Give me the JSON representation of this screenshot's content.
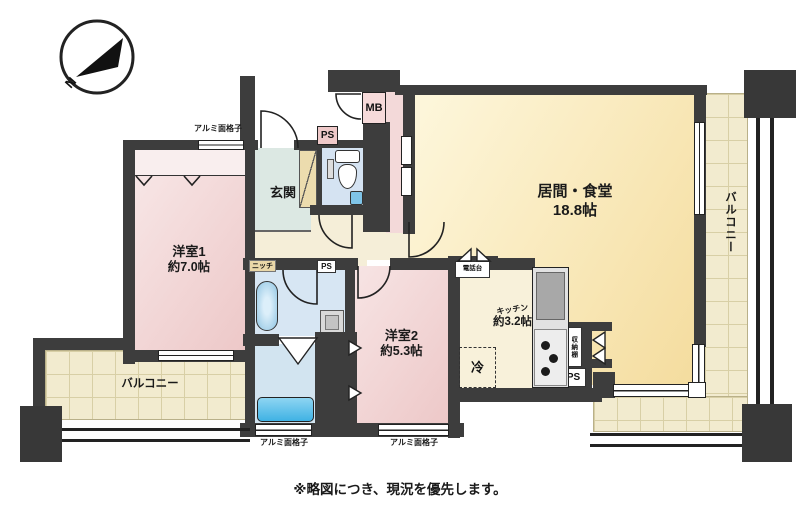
{
  "compass": {
    "north_label": "N"
  },
  "caption": "※略図につき、現況を優先します。",
  "rooms": {
    "bedroom1": {
      "name": "洋室1",
      "size": "約7.0帖"
    },
    "bedroom2": {
      "name": "洋室2",
      "size": "約5.3帖"
    },
    "living_dining": {
      "name": "居間・食堂",
      "size": "18.8帖"
    },
    "kitchen": {
      "name": "キッチン",
      "size": "約3.2帖"
    },
    "entrance": {
      "name": "玄関"
    },
    "balcony_right": {
      "name": "バルコニー"
    },
    "balcony_bottom": {
      "name": "バルコニー"
    }
  },
  "fixtures": {
    "meter_box": "MB",
    "pipe_space_entrance": "PS",
    "pipe_space_washroom": "PS",
    "pipe_space_kitchen": "PS",
    "niche": "ニッチ",
    "refrigerator": "冷",
    "telephone_stand": "電話台",
    "storage_shelf": "収納棚",
    "aluminum_grille_top": "アルミ面格子",
    "aluminum_grille_bathroom": "アルミ面格子",
    "aluminum_grille_bedroom2": "アルミ面格子"
  },
  "colors": {
    "wall": "#3d3d3d",
    "bedroom_pink": "#eecaca",
    "living_cream": "#f8e6b4",
    "wet_area_blue": "#d5e3f2",
    "balcony_tile": "#f2ebcf",
    "entrance_green": "#dce8e3",
    "bathtub_blue": "#4fb8e6"
  }
}
